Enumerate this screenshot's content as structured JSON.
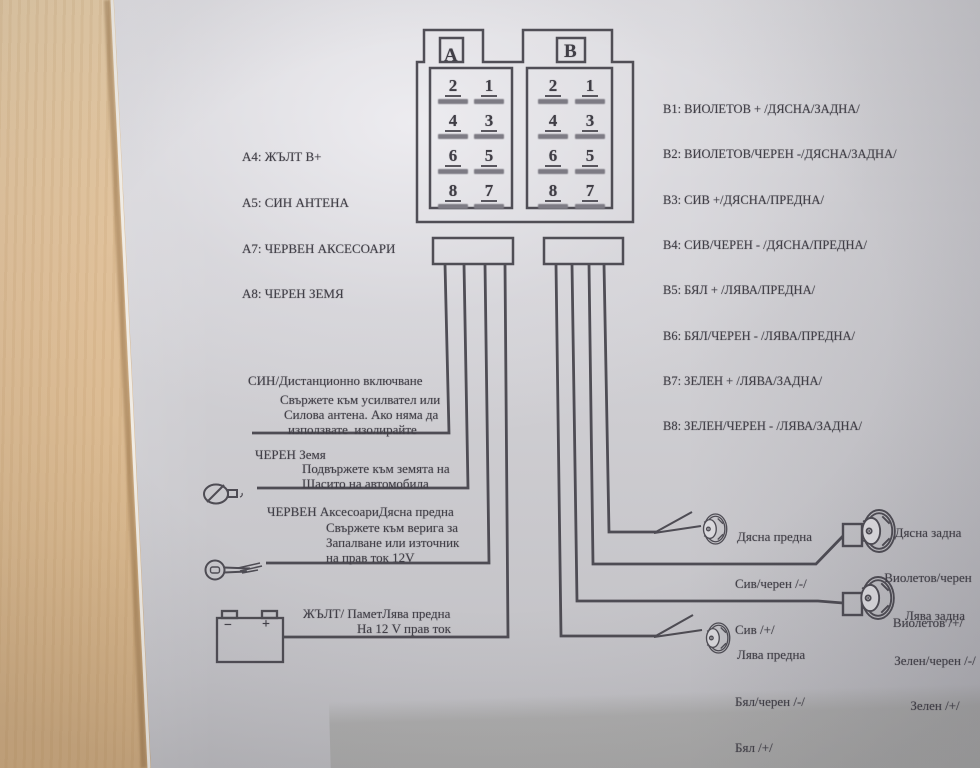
{
  "doc": {
    "connector": {
      "a_letter": "A",
      "b_letter": "B",
      "pin_rows": [
        [
          "2",
          "1"
        ],
        [
          "4",
          "3"
        ],
        [
          "6",
          "5"
        ],
        [
          "8",
          "7"
        ]
      ]
    },
    "a_list": [
      "A4: ЖЪЛТ B+",
      "A5: СИН АНТЕНА",
      "A7: ЧЕРВЕН АКСЕСОАРИ",
      "A8: ЧЕРЕН ЗЕМЯ"
    ],
    "b_list": [
      "B1: ВИОЛЕТОВ + /ДЯСНА/ЗАДНА/",
      "B2: ВИОЛЕТОВ/ЧЕРЕН -/ДЯСНА/ЗАДНА/",
      "B3: СИВ +/ДЯСНА/ПРЕДНА/",
      "B4: СИВ/ЧЕРЕН - /ДЯСНА/ПРЕДНА/",
      "B5: БЯЛ + /ЛЯВА/ПРЕДНА/",
      "B6: БЯЛ/ЧЕРЕН - /ЛЯВА/ПРЕДНА/",
      "B7: ЗЕЛЕН + /ЛЯВА/ЗАДНА/",
      "B8: ЗЕЛЕН/ЧЕРЕН - /ЛЯВА/ЗАДНА/"
    ],
    "notes": {
      "remote": {
        "title": "СИН/Дистанционно включване",
        "line2": "Свържете към усилвател или",
        "line3": "Силова антена. Ако няма да",
        "line4": "използвате  изолирайте"
      },
      "ground": {
        "title": "ЧЕРЕН Земя",
        "line2": "Подвържете към земята на",
        "line3": "Шасито на автомобила"
      },
      "accessory": {
        "title": "ЧЕРВЕН АксесоариДясна предна",
        "line2": "Свържете към верига за",
        "line3": "Запалване или източник",
        "line4": "на прав ток 12V"
      },
      "memory": {
        "title": "ЖЪЛТ/ ПаметЛява предна",
        "line2": "На 12 V прав ток"
      }
    },
    "speakers": {
      "front_right": {
        "l1": "Дясна предна",
        "l2": "Сив/черен /-/",
        "l3": "Сив /+/"
      },
      "rear_right": {
        "l1": "Дясна задна",
        "l2": "Виолетов/черен",
        "l3": "Виолетов /+/"
      },
      "rear_left": {
        "l1": "Лява задна",
        "l2": "Зелен/черен /-/",
        "l3": "Зелен /+/"
      },
      "front_left": {
        "l1": "Лява предна",
        "l2": "Бял/черен /-/",
        "l3": "Бял /+/"
      }
    },
    "battery": {
      "minus": "−",
      "plus": "+"
    }
  },
  "colors": {
    "ink": "#413f47",
    "paper": "#d6d5d9",
    "wood": "#dfc09a"
  }
}
